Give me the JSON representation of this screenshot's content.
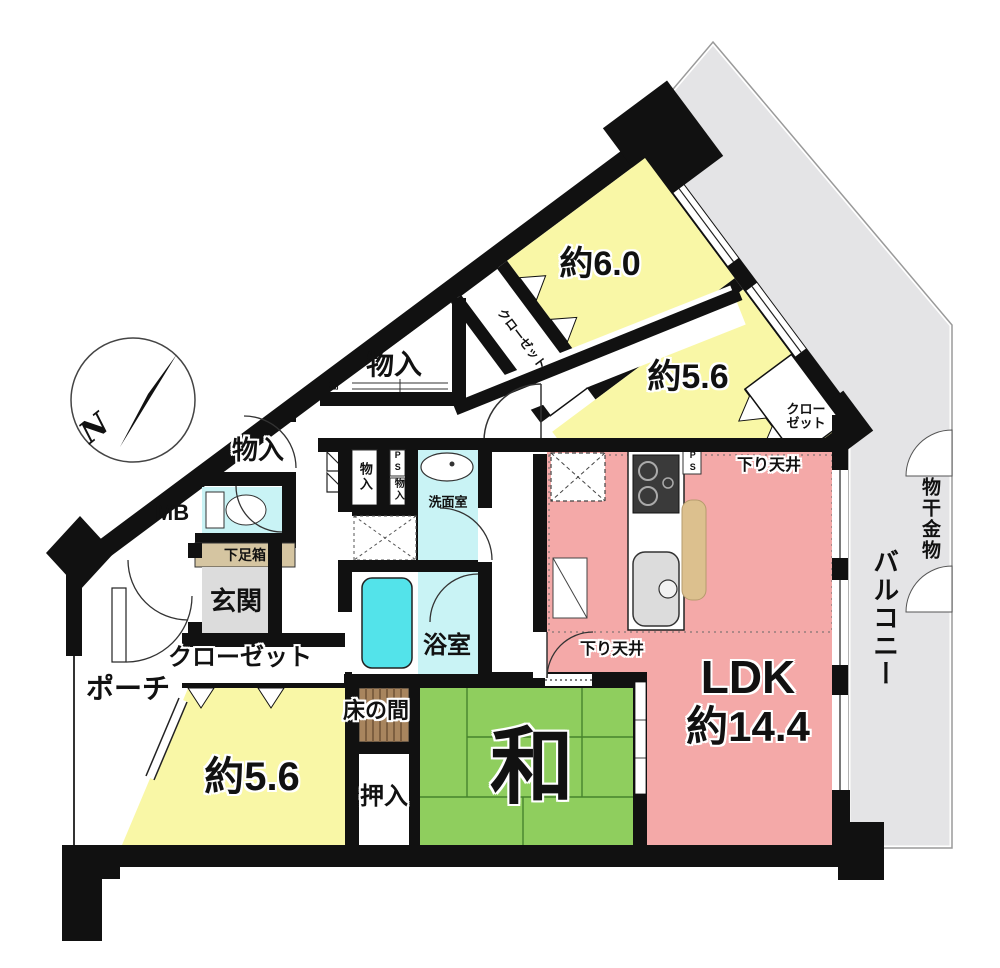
{
  "plan": {
    "compass_n": "N",
    "rooms": {
      "bedroom_top": "約6.0",
      "bedroom_right": "約5.6",
      "bedroom_bottom": "約5.6",
      "ldk_title": "LDK",
      "ldk_size": "約14.4",
      "japanese_room": "和",
      "bathroom": "浴室",
      "washroom": "洗面室",
      "entrance": "玄関",
      "porch": "ポーチ"
    },
    "storage": {
      "closet_hall": "クローゼット",
      "closet_wing": "クローゼット",
      "closet_56_line1": "クロー",
      "closet_56_line2": "ゼット",
      "monoiri_triangle": "物入",
      "monoiri_hall": "物入",
      "monoiri_vertical": "物入",
      "monoiri_small": "物入",
      "shelf": "棚",
      "shoe_box": "下足箱",
      "tokonoma": "床の間",
      "oshiire": "押入"
    },
    "labels": {
      "mb": "MB",
      "ps_hall": "PS",
      "ps_kitchen": "PS",
      "dropped_ceiling_upper": "下り天井",
      "dropped_ceiling_lower": "下り天井",
      "balcony": "バルコニー",
      "laundry_hardware": "物干金物"
    },
    "colors": {
      "room_yellow": "#f9f7a6",
      "ldk_pink": "#f4a9a8",
      "tatami_green": "#8fce5e",
      "water_cyan": "#c9f3f5",
      "tub_cyan": "#53e3ea",
      "balcony_gray": "#e4e4e6",
      "wall_black": "#111111",
      "tokonoma_brown": "#a8855e",
      "counter_tan": "#dcc08e",
      "entrance_gray": "#dcdcdc",
      "shoebox_tan": "#d5c5a1"
    }
  }
}
